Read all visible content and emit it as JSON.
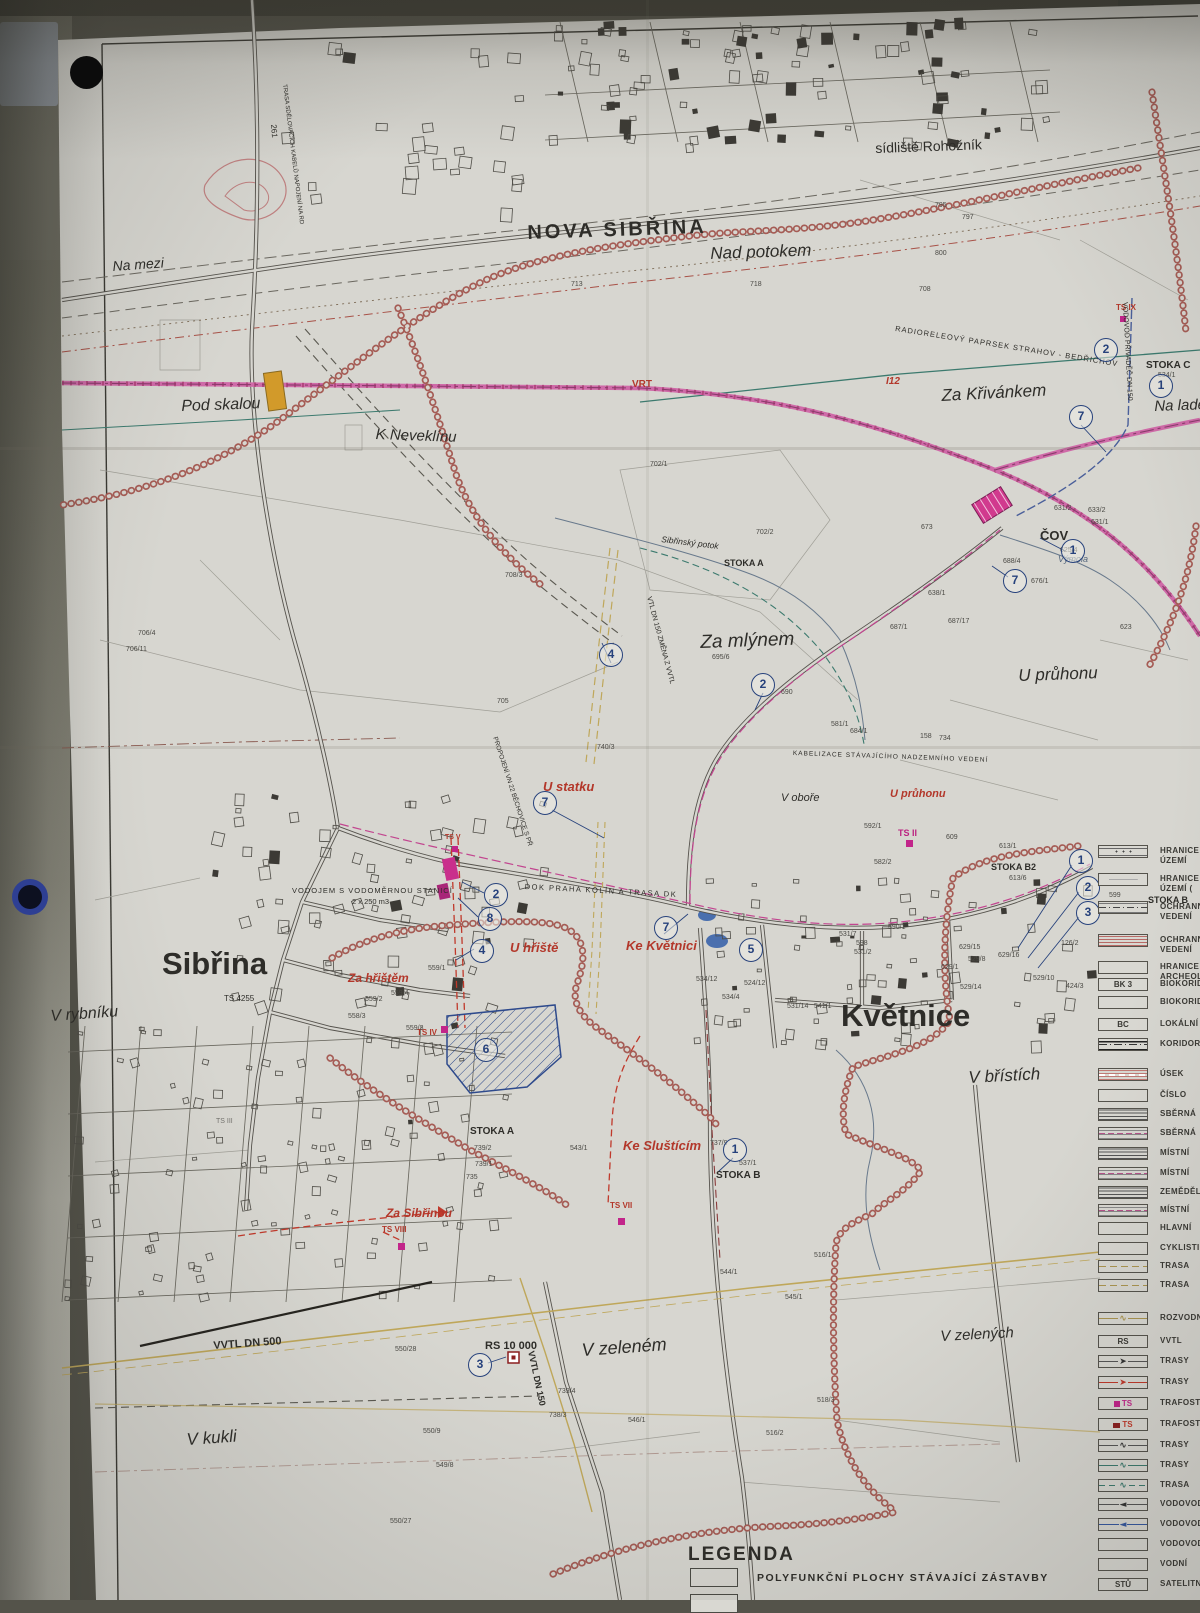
{
  "photo": {
    "surface_color": "#54534a",
    "paper_color": "#d7d6d0",
    "hole_punches": 2
  },
  "map": {
    "colors": {
      "boundary_chain": "#a55c55",
      "vrt_line": "#cf6aa8",
      "gas_line": "#bfa75a",
      "water_line": "#3c7a6e",
      "sewer_line": "#c2458f",
      "red_dashed": "#c0392b",
      "marker_blue": "#27427c",
      "site_outline": "#2e4a8c",
      "ts_magenta": "#c2258a",
      "crossing_marker_orange": "#d29a2a"
    },
    "place_labels": [
      {
        "t": "NOVA SIBŘINA",
        "x": 527,
        "y": 222,
        "s": 20,
        "w": 600,
        "ls": 3,
        "r": -2
      },
      {
        "t": "sídliště Rohožník",
        "x": 875,
        "y": 140,
        "s": 14,
        "r": -2
      },
      {
        "t": "Nad potokem",
        "x": 710,
        "y": 244,
        "s": 17,
        "i": 1,
        "r": -2
      },
      {
        "t": "Na mezi",
        "x": 112,
        "y": 258,
        "s": 14,
        "i": 1,
        "r": -4
      },
      {
        "t": "Pod skalou",
        "x": 181,
        "y": 398,
        "s": 16,
        "i": 1,
        "r": -2
      },
      {
        "t": "K Neveklínu",
        "x": 376,
        "y": 426,
        "s": 15,
        "i": 1,
        "r": 2
      },
      {
        "t": "Za Křivánkem",
        "x": 941,
        "y": 386,
        "s": 17,
        "i": 1,
        "r": -3
      },
      {
        "t": "Na ladech",
        "x": 1154,
        "y": 398,
        "s": 15,
        "i": 1,
        "r": -2
      },
      {
        "t": "STOKA C",
        "x": 1146,
        "y": 360,
        "s": 10,
        "w": 700
      },
      {
        "t": "Za mlýnem",
        "x": 700,
        "y": 632,
        "s": 19,
        "i": 1,
        "r": -2
      },
      {
        "t": "U průhonu",
        "x": 1018,
        "y": 666,
        "s": 17,
        "i": 1,
        "r": -2
      },
      {
        "t": "U statku",
        "x": 543,
        "y": 779,
        "s": 13,
        "c": "red",
        "i": 1,
        "w": 700
      },
      {
        "t": "V oboře",
        "x": 781,
        "y": 792,
        "s": 11,
        "i": 1
      },
      {
        "t": "U průhonu",
        "x": 890,
        "y": 788,
        "s": 11,
        "c": "red",
        "i": 1,
        "w": 700
      },
      {
        "t": "ČOV",
        "x": 1040,
        "y": 528,
        "s": 13,
        "w": 700
      },
      {
        "t": "Výmola",
        "x": 1058,
        "y": 554,
        "s": 9,
        "c": "stream",
        "i": 1
      },
      {
        "t": "VRT",
        "x": 632,
        "y": 379,
        "s": 10,
        "c": "red",
        "w": 700
      },
      {
        "t": "I12",
        "x": 886,
        "y": 376,
        "s": 10,
        "c": "red",
        "i": 1,
        "w": 700
      },
      {
        "t": "TS IX",
        "x": 1116,
        "y": 303,
        "s": 8,
        "c": "red",
        "w": 700
      },
      {
        "t": "TS II",
        "x": 898,
        "y": 828,
        "s": 9,
        "c": "magenta",
        "w": 700
      },
      {
        "t": "STOKA B2",
        "x": 991,
        "y": 862,
        "s": 9,
        "w": 700
      },
      {
        "t": "Sibřina",
        "x": 162,
        "y": 946,
        "s": 31,
        "w": 700
      },
      {
        "t": "Květnice",
        "x": 841,
        "y": 998,
        "s": 31,
        "w": 700
      },
      {
        "t": "V rybníku",
        "x": 50,
        "y": 1008,
        "s": 16,
        "i": 1,
        "r": -4
      },
      {
        "t": "V břístích",
        "x": 968,
        "y": 1068,
        "s": 17,
        "i": 1,
        "r": -3
      },
      {
        "t": "Za hřištěm",
        "x": 348,
        "y": 971,
        "s": 12,
        "c": "red",
        "i": 1,
        "w": 700
      },
      {
        "t": "U hřiště",
        "x": 510,
        "y": 940,
        "s": 13,
        "c": "red",
        "i": 1,
        "w": 700
      },
      {
        "t": "Ke Květnici",
        "x": 626,
        "y": 938,
        "s": 13,
        "c": "red",
        "i": 1,
        "w": 700
      },
      {
        "t": "TS IV",
        "x": 417,
        "y": 1028,
        "s": 8,
        "c": "red",
        "w": 700
      },
      {
        "t": "TS V",
        "x": 445,
        "y": 834,
        "s": 7,
        "c": "red",
        "w": 700
      },
      {
        "t": "TS 4255",
        "x": 224,
        "y": 994,
        "s": 8
      },
      {
        "t": "TS III",
        "x": 216,
        "y": 1118,
        "s": 7,
        "o": 0.6
      },
      {
        "t": "VODOJEM S VODOMĚRNOU STANICÍ",
        "x": 292,
        "y": 886,
        "s": 7.5,
        "ls": 1
      },
      {
        "t": "2 x 250 m3",
        "x": 352,
        "y": 897,
        "s": 7.5
      },
      {
        "t": "DOK PRAHA KOLÍN A TRASA DK",
        "x": 525,
        "y": 882,
        "s": 7.5,
        "r": 3,
        "ls": 1.5
      },
      {
        "t": "KABELIZACE STÁVAJÍCÍHO NADZEMNÍHO VEDENÍ",
        "x": 793,
        "y": 750,
        "s": 6.5,
        "r": 2,
        "ls": 1
      },
      {
        "t": "RADIORELEOVÝ PAPRSEK STRAHOV - BEDŘICHOV",
        "x": 896,
        "y": 324,
        "s": 7.5,
        "r": 9,
        "ls": 1
      },
      {
        "t": "VODOVOD PŘIVADĚČ DN 150",
        "x": 1128,
        "y": 302,
        "s": 7,
        "r": 87
      },
      {
        "t": "VTL DN 150 ZMĚNA Z VVTL",
        "x": 652,
        "y": 596,
        "s": 7,
        "r": 75
      },
      {
        "t": "PROPOJENÍ VN 22 BĚCHOVICE S PŘ",
        "x": 498,
        "y": 736,
        "s": 6.5,
        "r": 72
      },
      {
        "t": "TRASA SDĚLOVACÍCH KABELŮ NAPOJENÍ NA RD",
        "x": 287,
        "y": 84,
        "s": 6,
        "r": 83
      },
      {
        "t": "261",
        "x": 278,
        "y": 124,
        "s": 8,
        "r": 85
      },
      {
        "t": "STOKA A",
        "x": 724,
        "y": 558,
        "s": 9,
        "w": 700
      },
      {
        "t": "Sibřinský potok",
        "x": 662,
        "y": 534,
        "s": 8.5,
        "i": 1,
        "r": 7
      },
      {
        "t": "STOKA A",
        "x": 470,
        "y": 1126,
        "s": 10,
        "w": 700
      },
      {
        "t": "Ke Sluštícím",
        "x": 623,
        "y": 1138,
        "s": 13,
        "c": "red",
        "i": 1,
        "w": 700
      },
      {
        "t": "STOKA B",
        "x": 716,
        "y": 1170,
        "s": 10,
        "w": 700
      },
      {
        "t": "STOKA B",
        "x": 1148,
        "y": 895,
        "s": 9,
        "w": 700
      },
      {
        "t": "TS VII",
        "x": 610,
        "y": 1201,
        "s": 8,
        "c": "red",
        "w": 700
      },
      {
        "t": "Za Sibřinou",
        "x": 386,
        "y": 1206,
        "s": 12,
        "c": "red",
        "i": 1,
        "w": 700
      },
      {
        "t": "TS VIII",
        "x": 382,
        "y": 1225,
        "s": 8,
        "c": "red",
        "w": 700
      },
      {
        "t": "RS 10 000",
        "x": 485,
        "y": 1340,
        "s": 11,
        "w": 700
      },
      {
        "t": "VVTL DN 500",
        "x": 213,
        "y": 1340,
        "s": 11,
        "w": 700,
        "r": -4
      },
      {
        "t": "VVTL DN 150",
        "x": 536,
        "y": 1350,
        "s": 9,
        "w": 700,
        "r": 78
      },
      {
        "t": "V zeleném",
        "x": 581,
        "y": 1340,
        "s": 18,
        "i": 1,
        "r": -4
      },
      {
        "t": "V zelených",
        "x": 940,
        "y": 1328,
        "s": 15,
        "i": 1,
        "r": -3
      },
      {
        "t": "V kukli",
        "x": 186,
        "y": 1430,
        "s": 17,
        "i": 1,
        "r": -4
      }
    ],
    "parcel_numbers": [
      {
        "t": "795",
        "x": 935,
        "y": 202
      },
      {
        "t": "797",
        "x": 962,
        "y": 214
      },
      {
        "t": "800",
        "x": 935,
        "y": 250
      },
      {
        "t": "718",
        "x": 750,
        "y": 281
      },
      {
        "t": "713",
        "x": 571,
        "y": 281
      },
      {
        "t": "708",
        "x": 919,
        "y": 286
      },
      {
        "t": "706/4",
        "x": 138,
        "y": 630
      },
      {
        "t": "706/11",
        "x": 126,
        "y": 646
      },
      {
        "t": "705",
        "x": 497,
        "y": 698
      },
      {
        "t": "708/3",
        "x": 505,
        "y": 572
      },
      {
        "t": "702/1",
        "x": 650,
        "y": 461
      },
      {
        "t": "702/2",
        "x": 756,
        "y": 529
      },
      {
        "t": "695/6",
        "x": 712,
        "y": 654
      },
      {
        "t": "690",
        "x": 781,
        "y": 689
      },
      {
        "t": "687/1",
        "x": 890,
        "y": 624
      },
      {
        "t": "687/17",
        "x": 948,
        "y": 618
      },
      {
        "t": "638/1",
        "x": 928,
        "y": 590
      },
      {
        "t": "684/1",
        "x": 850,
        "y": 728
      },
      {
        "t": "581/1",
        "x": 831,
        "y": 721
      },
      {
        "t": "158",
        "x": 920,
        "y": 733
      },
      {
        "t": "734",
        "x": 939,
        "y": 735
      },
      {
        "t": "740/3",
        "x": 597,
        "y": 744
      },
      {
        "t": "673",
        "x": 921,
        "y": 524
      },
      {
        "t": "631/2",
        "x": 1054,
        "y": 505
      },
      {
        "t": "633/2",
        "x": 1088,
        "y": 507
      },
      {
        "t": "631/1",
        "x": 1091,
        "y": 519
      },
      {
        "t": "625/4",
        "x": 1060,
        "y": 547
      },
      {
        "t": "688/4",
        "x": 1003,
        "y": 558
      },
      {
        "t": "676/1",
        "x": 1031,
        "y": 578
      },
      {
        "t": "623",
        "x": 1120,
        "y": 624
      },
      {
        "t": "534/1",
        "x": 1158,
        "y": 372
      },
      {
        "t": "592/1",
        "x": 864,
        "y": 823
      },
      {
        "t": "582/2",
        "x": 874,
        "y": 859
      },
      {
        "t": "609",
        "x": 946,
        "y": 834
      },
      {
        "t": "613/1",
        "x": 999,
        "y": 843
      },
      {
        "t": "613/6",
        "x": 1009,
        "y": 875
      },
      {
        "t": "599",
        "x": 1109,
        "y": 892
      },
      {
        "t": "590/1",
        "x": 888,
        "y": 924
      },
      {
        "t": "598",
        "x": 856,
        "y": 940
      },
      {
        "t": "531/2",
        "x": 854,
        "y": 949
      },
      {
        "t": "629/15",
        "x": 959,
        "y": 944
      },
      {
        "t": "629/16",
        "x": 998,
        "y": 952
      },
      {
        "t": "629/1",
        "x": 941,
        "y": 964
      },
      {
        "t": "529/8",
        "x": 968,
        "y": 956
      },
      {
        "t": "529/10",
        "x": 1033,
        "y": 975
      },
      {
        "t": "529/14",
        "x": 960,
        "y": 984
      },
      {
        "t": "424/3",
        "x": 1066,
        "y": 983
      },
      {
        "t": "126/2",
        "x": 1061,
        "y": 940
      },
      {
        "t": "534/12",
        "x": 696,
        "y": 976
      },
      {
        "t": "524/12",
        "x": 744,
        "y": 980
      },
      {
        "t": "534/4",
        "x": 722,
        "y": 994
      },
      {
        "t": "531/7",
        "x": 839,
        "y": 931
      },
      {
        "t": "531/14",
        "x": 787,
        "y": 1003
      },
      {
        "t": "541/1",
        "x": 814,
        "y": 1003
      },
      {
        "t": "559/1",
        "x": 428,
        "y": 965
      },
      {
        "t": "559/4",
        "x": 391,
        "y": 990
      },
      {
        "t": "559/2",
        "x": 365,
        "y": 996
      },
      {
        "t": "558/3",
        "x": 348,
        "y": 1013
      },
      {
        "t": "559/3",
        "x": 406,
        "y": 1025
      },
      {
        "t": "739/2",
        "x": 474,
        "y": 1145
      },
      {
        "t": "739/1",
        "x": 475,
        "y": 1161
      },
      {
        "t": "735",
        "x": 466,
        "y": 1174
      },
      {
        "t": "543/1",
        "x": 570,
        "y": 1145
      },
      {
        "t": "737/9",
        "x": 710,
        "y": 1140
      },
      {
        "t": "537/1",
        "x": 739,
        "y": 1160
      },
      {
        "t": "544/1",
        "x": 720,
        "y": 1269
      },
      {
        "t": "545/1",
        "x": 785,
        "y": 1294
      },
      {
        "t": "516/1",
        "x": 814,
        "y": 1252
      },
      {
        "t": "550/28",
        "x": 395,
        "y": 1346
      },
      {
        "t": "739/4",
        "x": 558,
        "y": 1388
      },
      {
        "t": "738/3",
        "x": 549,
        "y": 1412
      },
      {
        "t": "546/1",
        "x": 628,
        "y": 1417
      },
      {
        "t": "518/3",
        "x": 817,
        "y": 1397
      },
      {
        "t": "516/2",
        "x": 766,
        "y": 1430
      },
      {
        "t": "550/9",
        "x": 423,
        "y": 1428
      },
      {
        "t": "549/8",
        "x": 436,
        "y": 1462
      },
      {
        "t": "550/27",
        "x": 390,
        "y": 1518
      }
    ],
    "markers": [
      {
        "n": "2",
        "x": 1106,
        "y": 350
      },
      {
        "n": "1",
        "x": 1161,
        "y": 386
      },
      {
        "n": "7",
        "x": 1081,
        "y": 417
      },
      {
        "n": "1",
        "x": 1073,
        "y": 551
      },
      {
        "n": "7",
        "x": 1015,
        "y": 581
      },
      {
        "n": "4",
        "x": 611,
        "y": 655
      },
      {
        "n": "2",
        "x": 763,
        "y": 685
      },
      {
        "n": "7",
        "x": 545,
        "y": 803
      },
      {
        "n": "2",
        "x": 496,
        "y": 895
      },
      {
        "n": "8",
        "x": 490,
        "y": 919
      },
      {
        "n": "4",
        "x": 482,
        "y": 951
      },
      {
        "n": "7",
        "x": 666,
        "y": 928
      },
      {
        "n": "5",
        "x": 751,
        "y": 950
      },
      {
        "n": "1",
        "x": 1081,
        "y": 861
      },
      {
        "n": "2",
        "x": 1088,
        "y": 888
      },
      {
        "n": "3",
        "x": 1088,
        "y": 913
      },
      {
        "n": "6",
        "x": 486,
        "y": 1050
      },
      {
        "n": "1",
        "x": 735,
        "y": 1150
      },
      {
        "n": "3",
        "x": 480,
        "y": 1365
      }
    ]
  },
  "legend": {
    "rows": [
      {
        "y": 845,
        "swatch": "dots",
        "label": "HRANICE",
        "label2": "ÚZEMÍ"
      },
      {
        "y": 873,
        "swatch": "faint",
        "label": "HRANICE",
        "label2": "ÚZEMÍ ("
      },
      {
        "y": 901,
        "swatch": "dashdot",
        "label": "OCHRANNÉ",
        "label2": "VEDENÍ"
      },
      {
        "y": 934,
        "swatch": "stripes-pink",
        "label": "OCHRANNÉ",
        "label2": "VEDENÍ"
      },
      {
        "y": 961,
        "swatch": "empty",
        "label": "HRANICE",
        "label2": "ARCHEOL"
      },
      {
        "y": 978,
        "code": "BK 3",
        "swatch": "code",
        "label": "BIOKORIDOR"
      },
      {
        "y": 996,
        "swatch": "empty",
        "label": "BIOKORIDOR"
      },
      {
        "y": 1018,
        "code": "BC",
        "swatch": "code",
        "label": "LOKÁLNÍ"
      },
      {
        "y": 1038,
        "swatch": "koridor",
        "label": "KORIDOR"
      },
      {
        "y": 1068,
        "swatch": "stripes-pink2",
        "label": "ÚSEK"
      },
      {
        "y": 1089,
        "swatch": "empty",
        "label": "ČÍSLO"
      },
      {
        "y": 1108,
        "swatch": "hlines",
        "label": "SBĚRNÁ"
      },
      {
        "y": 1127,
        "swatch": "hlines-dash",
        "label": "SBĚRNÁ"
      },
      {
        "y": 1147,
        "swatch": "hlines",
        "label": "MÍSTNÍ"
      },
      {
        "y": 1167,
        "swatch": "hlines-dash",
        "label": "MÍSTNÍ"
      },
      {
        "y": 1186,
        "swatch": "hlines",
        "label": "ZEMĚDĚLSKÁ"
      },
      {
        "y": 1204,
        "swatch": "hlines-dash",
        "label": "MÍSTNÍ"
      },
      {
        "y": 1222,
        "swatch": "empty",
        "label": "HLAVNÍ"
      },
      {
        "y": 1242,
        "swatch": "empty",
        "label": "CYKLISTICKÁ"
      },
      {
        "y": 1260,
        "swatch": "tan-dash",
        "label": "TRASA"
      },
      {
        "y": 1279,
        "swatch": "tan-dash",
        "label": "TRASA"
      },
      {
        "y": 1312,
        "swatch": "tan-wave",
        "label": "ROZVODNA"
      },
      {
        "y": 1335,
        "code": "RS",
        "swatch": "code",
        "label": "VVTL"
      },
      {
        "y": 1355,
        "swatch": "arrow-black",
        "label": "TRASY"
      },
      {
        "y": 1376,
        "swatch": "arrow-red",
        "label": "TRASY"
      },
      {
        "y": 1397,
        "code": "TS",
        "swatch": "ts-magenta",
        "label": "TRAFOSTANICE"
      },
      {
        "y": 1418,
        "code": "TS",
        "swatch": "ts-darkred",
        "label": "TRAFOSTANICE"
      },
      {
        "y": 1439,
        "swatch": "wave-black",
        "label": "TRASY"
      },
      {
        "y": 1459,
        "swatch": "wave-green",
        "label": "TRASY"
      },
      {
        "y": 1479,
        "swatch": "wave-green2",
        "label": "TRASA"
      },
      {
        "y": 1498,
        "swatch": "arrow-vblack",
        "label": "VODOVOD"
      },
      {
        "y": 1518,
        "swatch": "arrow-vblue",
        "label": "VODOVOD"
      },
      {
        "y": 1538,
        "swatch": "empty",
        "label": "VODOVOD"
      },
      {
        "y": 1558,
        "swatch": "empty",
        "label": "VODNÍ"
      },
      {
        "y": 1578,
        "code": "STŮ",
        "swatch": "code",
        "label": "SATELITNÍ"
      }
    ]
  },
  "legend_bottom": {
    "title": "LEGENDA",
    "items": [
      {
        "label": "POLYFUNKČNÍ PLOCHY STÁVAJÍCÍ ZÁSTAVBY"
      }
    ]
  }
}
